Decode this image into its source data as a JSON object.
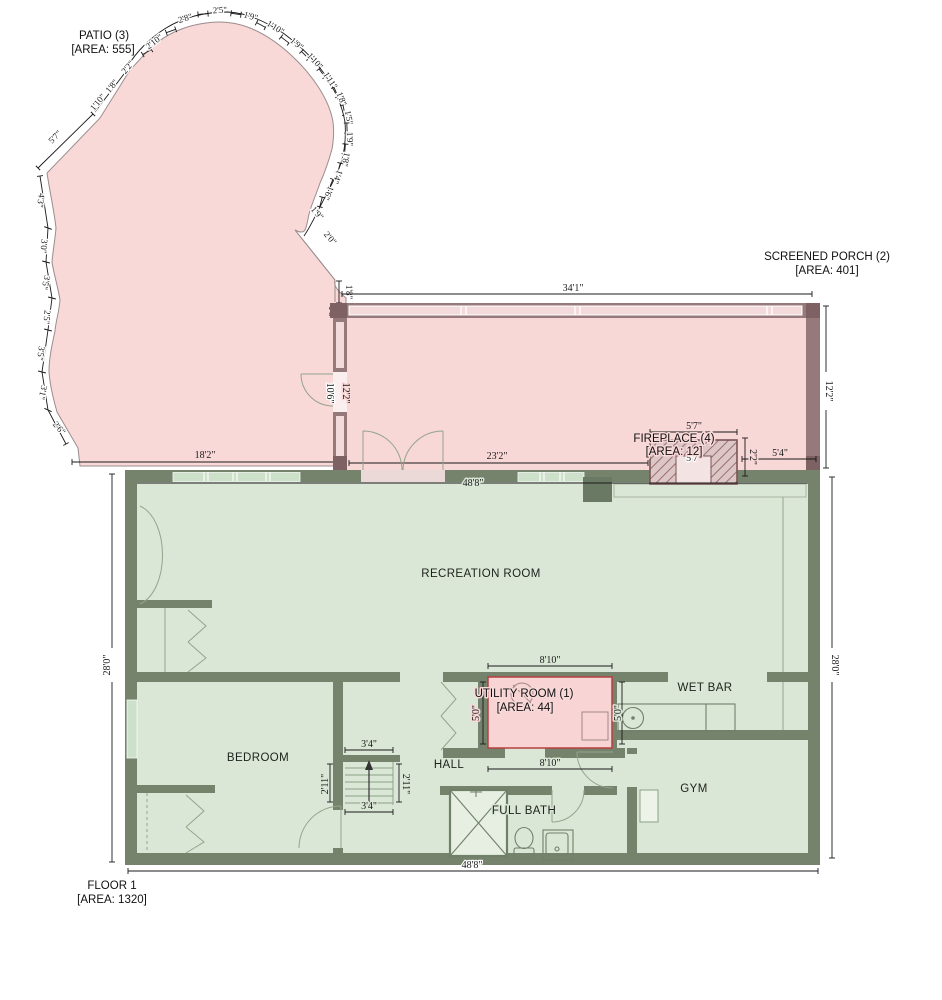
{
  "patio": {
    "label": "PATIO (3)",
    "area": "[AREA: 555]",
    "left_up": [
      "5'7\"",
      "1'10\"",
      "1'8\"",
      "2'2\""
    ],
    "top": [
      "2'10\"",
      "2'8\"",
      "2'5\"",
      "1'9\"",
      "1'10\"",
      "1'9\"",
      "1'10\"",
      "1'11\"",
      "1'8\"",
      "1'5\"",
      "1'9\"",
      "1'8\"",
      "1'4\"",
      "1'6\"",
      "1'9\"",
      "2'0\"",
      "1'8\"",
      "1'8\""
    ],
    "left_down": [
      "4'3\"",
      "3'0\"",
      "3'5\"",
      "2'5\"",
      "3'5\"",
      "3'1\"",
      "2'6\""
    ],
    "bottom": "18'2\""
  },
  "porch": {
    "label": "SCREENED PORCH (2)",
    "area": "[AREA: 401]",
    "dim_top": "34'1\"",
    "dim_right": "12'2\"",
    "dim_left_wall": "12'2\"",
    "dim_door": "10'6\"",
    "dim_bottom": "23'2\""
  },
  "fireplace": {
    "label": "FIREPLACE (4)",
    "area": "[AREA: 12]",
    "dim_width": "5'7\"",
    "dim_firebox": "5'7\"",
    "dim_depth": "2'2\"",
    "dim_side": "5'4\""
  },
  "floor": {
    "label": "FLOOR 1",
    "area": "[AREA: 1320]",
    "dim_width_top": "48'8\"",
    "dim_width_bottom": "48'8\"",
    "dim_height_left": "28'0\"",
    "dim_height_right": "28'0\""
  },
  "rooms": {
    "recreation": "RECREATION ROOM",
    "bedroom": "BEDROOM",
    "hall": "HALL",
    "gym": "GYM",
    "wet_bar": "WET BAR",
    "full_bath": "FULL BATH"
  },
  "utility": {
    "label": "UTILITY ROOM (1)",
    "area": "[AREA: 44]",
    "dim_width_top": "8'10\"",
    "dim_width_bottom": "8'10\"",
    "dim_height_left": "5'0\"",
    "dim_height_right": "5'0\""
  },
  "stairs": {
    "dim_width_top": "3'4\"",
    "dim_width_bottom": "3'4\"",
    "dim_height_left": "2'11\"",
    "dim_height_right": "2'11\""
  },
  "colors": {
    "patio_fill": "#f9d8d8",
    "porch_wall": "#96797b",
    "floor_wall": "#75836d",
    "floor_fill": "#dbe7d6",
    "utility_stroke": "#b84040"
  }
}
